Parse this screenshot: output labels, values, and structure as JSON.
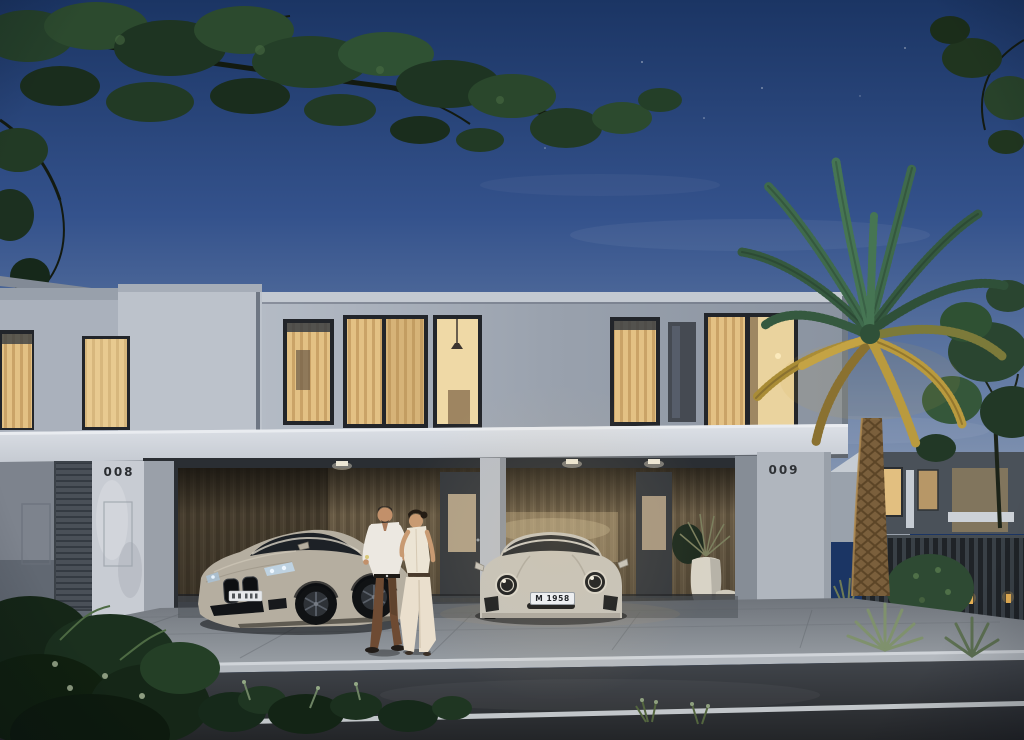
{
  "scene": {
    "type": "architectural dusk rendering",
    "description": "Modern two-storey townhouse villas at dusk with lit upper windows, a carport with two parked sports cars, a couple walking on the driveway, a palm tree and landscaped garden beside the street"
  },
  "labels": {
    "left_unit_number": "008",
    "right_unit_number": "009",
    "porsche_plate": "M 1958"
  },
  "colors": {
    "sky_top": "#1b3564",
    "sky_horizon": "#8596b2",
    "upper_wall": "#a9b1bd",
    "carport_slab": "#d7dbe1",
    "wood_slats": "#75664e",
    "window_glow": "#e8cd92",
    "road": "#2b2d31",
    "palm_green": "#3f6a4c",
    "palm_underlight": "#c4a344",
    "bmw_body": "#b5aea0",
    "porsche_body": "#c6c3bb"
  }
}
